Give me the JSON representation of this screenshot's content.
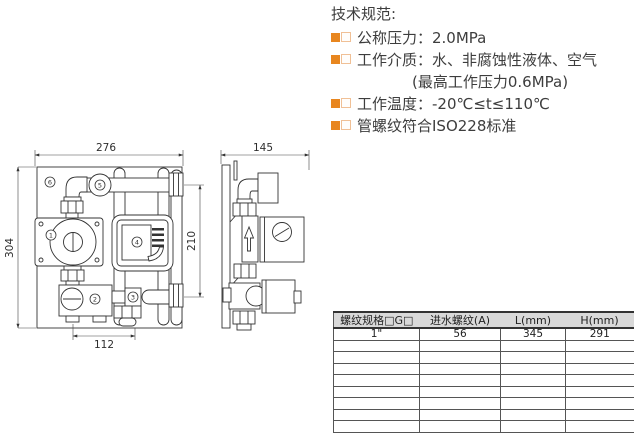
{
  "colors": {
    "accent_orange": "#e8861f",
    "bullet_outline": "#f0c096",
    "table_header_bg": "#d9d9d9",
    "drawing_line": "#333333",
    "text": "#3d3d3d"
  },
  "specs": {
    "title": "技术规范:",
    "items": [
      "公称压力：2.0MPa",
      "工作介质：水、非腐蚀性液体、空气",
      "(最高工作压力0.6MPa)",
      "工作温度：-20℃≤t≤110℃",
      "管螺纹符合ISO228标准"
    ]
  },
  "drawing": {
    "front_view": {
      "dim_width": "276",
      "dim_height": "304",
      "dim_right": "210",
      "dim_bottom": "112"
    },
    "side_view": {
      "dim_width": "145"
    },
    "callouts": [
      "1",
      "2",
      "3",
      "4",
      "5",
      "6"
    ]
  },
  "table": {
    "headers": [
      "螺纹规格□G□",
      "进水螺纹(A)",
      "L(mm)",
      "H(mm)"
    ],
    "rows": [
      [
        "1\"",
        "56",
        "345",
        "291"
      ],
      [
        "",
        "",
        "",
        ""
      ],
      [
        "",
        "",
        "",
        ""
      ],
      [
        "",
        "",
        "",
        ""
      ],
      [
        "",
        "",
        "",
        ""
      ],
      [
        "",
        "",
        "",
        ""
      ],
      [
        "",
        "",
        "",
        ""
      ],
      [
        "",
        "",
        "",
        ""
      ],
      [
        "",
        "",
        "",
        ""
      ]
    ]
  }
}
